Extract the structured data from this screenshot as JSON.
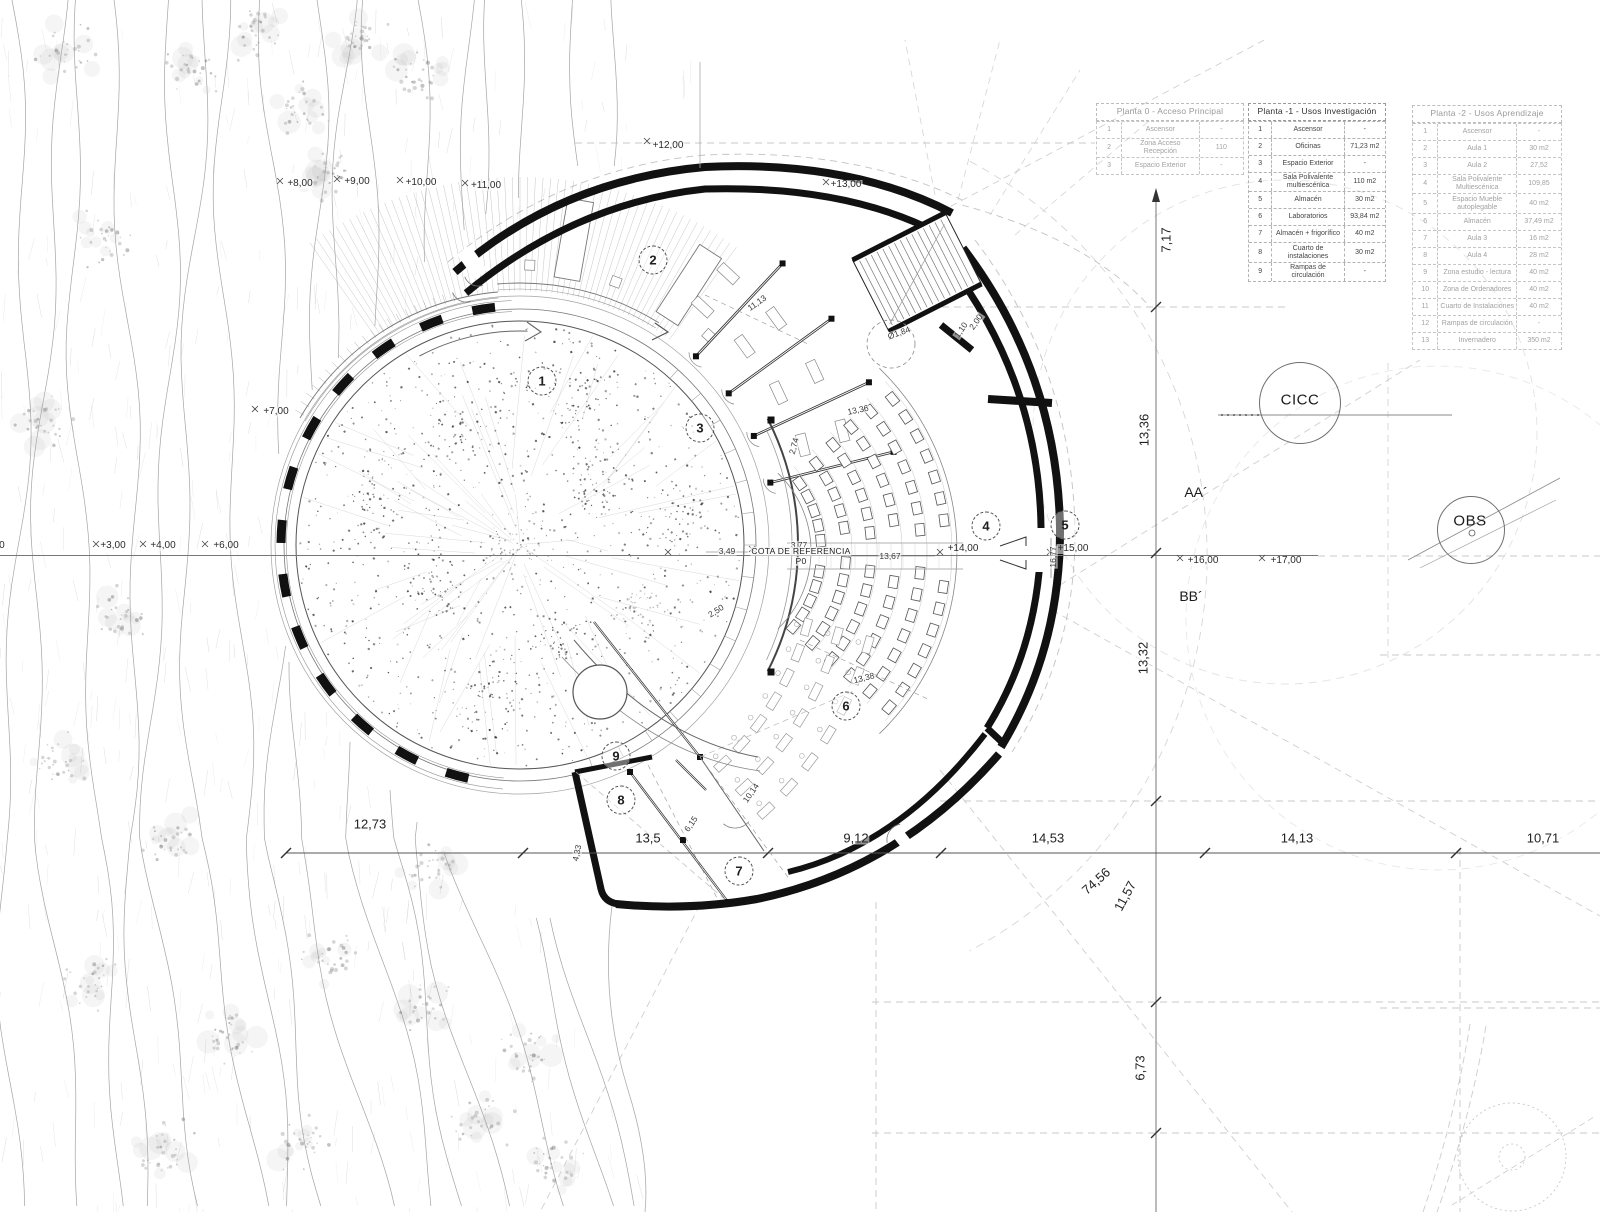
{
  "tables": {
    "t0": {
      "title": "Planta 0 - Acceso Principal",
      "rows": [
        {
          "num": "1",
          "name": "Ascensor",
          "area": "-"
        },
        {
          "num": "2",
          "name": "Zona Acceso Recepción",
          "area": "110"
        },
        {
          "num": "3",
          "name": "Espacio Exterior",
          "area": "-"
        }
      ]
    },
    "t1": {
      "title": "Planta -1 - Usos Investigación",
      "rows": [
        {
          "num": "1",
          "name": "Ascensor",
          "area": "-"
        },
        {
          "num": "2",
          "name": "Oficinas",
          "area": "71,23 m2"
        },
        {
          "num": "3",
          "name": "Espacio Exterior",
          "area": "-"
        },
        {
          "num": "4",
          "name": "Sala Polivalente multiescénica",
          "area": "110 m2"
        },
        {
          "num": "5",
          "name": "Almacén",
          "area": "30 m2"
        },
        {
          "num": "6",
          "name": "Laboratorios",
          "area": "93,84 m2"
        },
        {
          "num": "7",
          "name": "Almacén + frigorífico",
          "area": "40 m2"
        },
        {
          "num": "8",
          "name": "Cuarto de instalaciones",
          "area": "30 m2"
        },
        {
          "num": "9",
          "name": "Rampas de circulación",
          "area": "-"
        }
      ]
    },
    "t2": {
      "title": "Planta -2 - Usos Aprendizaje",
      "rows": [
        {
          "num": "1",
          "name": "Ascensor",
          "area": "-"
        },
        {
          "num": "2",
          "name": "Aula 1",
          "area": "30 m2"
        },
        {
          "num": "3",
          "name": "Aula 2",
          "area": "27,52"
        },
        {
          "num": "4",
          "name": "Sala Polivalente Multiescénica",
          "area": "109,85"
        },
        {
          "num": "5",
          "name": "Espacio Mueble autoplegable",
          "area": "40 m2"
        },
        {
          "num": "6",
          "name": "Almacén",
          "area": "37,49 m2"
        },
        {
          "num": "7",
          "name": "Aula 3",
          "area": "16 m2"
        },
        {
          "num": "8",
          "name": "Aula 4",
          "area": "28 m2"
        },
        {
          "num": "9",
          "name": "Zona estudio - lectura",
          "area": "40 m2"
        },
        {
          "num": "10",
          "name": "Zona de Ordenadores",
          "area": "40 m2"
        },
        {
          "num": "11",
          "name": "Cuarto de Instalaciones",
          "area": "40 m2"
        },
        {
          "num": "12",
          "name": "Rampas de circulación",
          "area": "-"
        },
        {
          "num": "13",
          "name": "Invernadero",
          "area": "350 m2"
        }
      ]
    }
  },
  "markers": {
    "m1": "1",
    "m2": "2",
    "m3": "3",
    "m4": "4",
    "m5": "5",
    "m6": "6",
    "m7": "7",
    "m8": "8",
    "m9": "9"
  },
  "labels": {
    "lv2": "+2,00",
    "lv3": "+3,00",
    "lv4": "+4,00",
    "lv6": "+6,00",
    "lv7": "+7,00",
    "lv8": "+8,00",
    "lv9": "+9,00",
    "lv10": "+10,00",
    "lv11": "+11,00",
    "lv12": "+12,00",
    "lv13": "+13,00",
    "lv14": "+14,00",
    "lv15": "+15,00",
    "lv16": "+16,00",
    "lv17": "+17,00",
    "d349": "3,49",
    "d377": "3,77",
    "d1367": "13,67",
    "d1677": "16,77",
    "d250": "2,50",
    "d274": "2,74",
    "d1113": "11,13",
    "d1336i": "13,36",
    "d1338": "13,38",
    "d1014": "10,14",
    "d615": "6,15",
    "d184": "Ø1,84",
    "d110": "1,10",
    "d200": "2,00",
    "d433": "4,33",
    "d1273": "12,73",
    "d135": "13,5",
    "d912": "9,12",
    "d1453": "14,53",
    "d1413": "14,13",
    "d1071": "10,71",
    "d717": "7,17",
    "d1336v": "13,36",
    "d1332": "13,32",
    "d1157": "11,57",
    "d7456": "74,56",
    "d673": "6,73"
  },
  "site": {
    "cicc": "CICC",
    "obs": "OBS",
    "aa": "AA´",
    "bb": "BB´",
    "cota_line1": "COTA DE REFERENCIA",
    "cota_line2": "P0"
  }
}
